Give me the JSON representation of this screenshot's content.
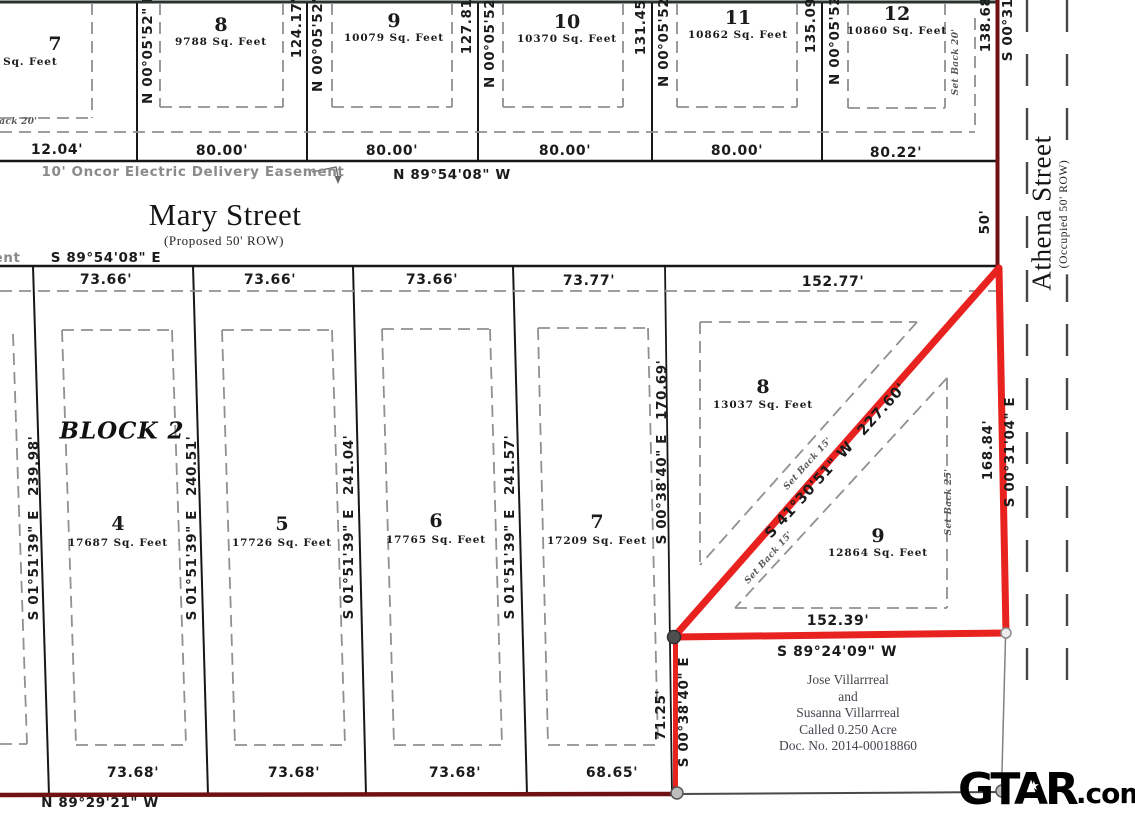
{
  "bearings": {
    "n000552e": "N 00°05'52\" E",
    "n895408w": "N 89°54'08\" W",
    "s895408e": "S 89°54'08\" E",
    "s015139e": "S 01°51'39\" E",
    "s003840e": "S 00°38'40\" E",
    "s003104e": "S 00°31'04\" E",
    "s892409w": "S 89°24'09\" W",
    "n892921w": "N 89°29'21\" W",
    "s413051w": "S 41°30'51\" W"
  },
  "streets": {
    "mary": {
      "name": "Mary Street",
      "row": "(Proposed 50' ROW)"
    },
    "athena": {
      "name": "Athena Street",
      "row": "(Occupied 50' ROW)",
      "width_label": "50'"
    }
  },
  "easement": {
    "label": "10' Oncor Electric Delivery Easement",
    "fragment": "ent"
  },
  "block_label": "BLOCK 2",
  "top_lots": [
    {
      "number": "7",
      "area": "0 Sq. Feet"
    },
    {
      "number": "8",
      "area": "9788 Sq. Feet"
    },
    {
      "number": "9",
      "area": "10079 Sq. Feet"
    },
    {
      "number": "10",
      "area": "10370 Sq. Feet"
    },
    {
      "number": "11",
      "area": "10862 Sq. Feet"
    },
    {
      "number": "12",
      "area": "10860 Sq. Feet"
    }
  ],
  "block2_lots": [
    {
      "number": "4",
      "area": "17687 Sq. Feet"
    },
    {
      "number": "5",
      "area": "17726 Sq. Feet"
    },
    {
      "number": "6",
      "area": "17765 Sq. Feet"
    },
    {
      "number": "7",
      "area": "17209 Sq. Feet"
    },
    {
      "number": "8",
      "area": "13037 Sq. Feet"
    },
    {
      "number": "9",
      "area": "12864 Sq. Feet"
    }
  ],
  "dims": {
    "top_side": [
      "124.17'",
      "127.81'",
      "131.45'",
      "135.09'",
      "138.68'"
    ],
    "top_bottom": [
      "12.04'",
      "80.00'",
      "80.00'",
      "80.00'",
      "80.00'",
      "80.22'"
    ],
    "mid_top": [
      "73.66'",
      "73.66'",
      "73.66'",
      "73.77'",
      "152.77'"
    ],
    "block2_side": [
      "239.98'",
      "240.51'",
      "241.04'",
      "241.57'"
    ],
    "lot7_side": "170.69'",
    "diagonal": "227.60'",
    "triangle_right": "168.84'",
    "triangle_bottom": "152.39'",
    "tract_side": "71.25'",
    "bottom": [
      "73.68'",
      "73.68'",
      "73.68'",
      "68.65'"
    ]
  },
  "setbacks": {
    "back20": "Set Back 20'",
    "back15": "Set Back 15'",
    "back25": "Set Back 25'"
  },
  "owner": {
    "line1": "Jose Villarrreal",
    "line2": "and",
    "line3": "Susanna Villarrreal",
    "line4": "Called 0.250 Acre",
    "line5": "Doc. No. 2014-00018860"
  },
  "logo": {
    "name": "GTAR",
    "suffix": ".com"
  }
}
